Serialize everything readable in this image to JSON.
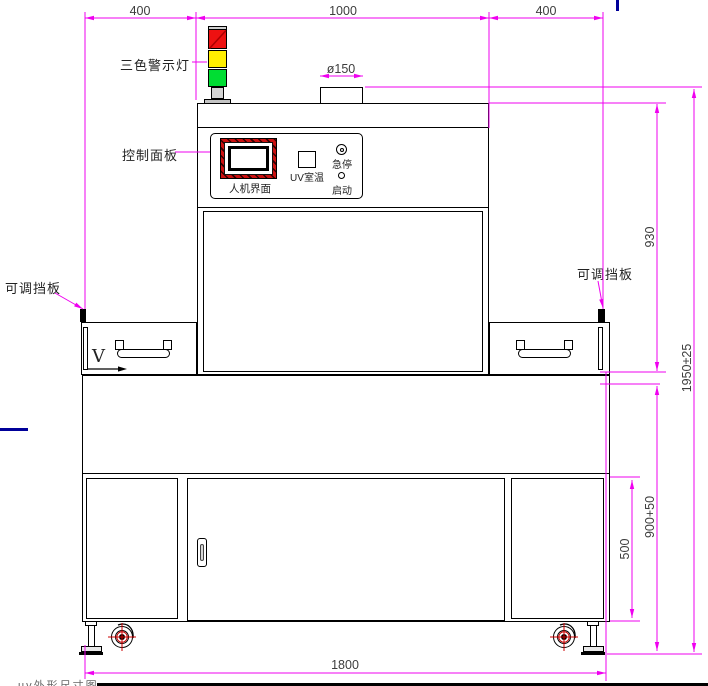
{
  "labels": {
    "tower_light": "三色警示灯",
    "control_panel": "控制面板",
    "hmi": "人机界面",
    "uv_temp": "UV室温",
    "estop": "急停",
    "start": "启动",
    "baffle_left": "可调挡板",
    "baffle_right": "可调挡板",
    "direction": "V"
  },
  "dims": {
    "top_left": "400",
    "top_center": "1000",
    "top_right": "400",
    "duct_diameter": "ø150",
    "upper_height": "930",
    "total_height": "1950±25",
    "base_height": "900+50",
    "door_height": "500",
    "overall_width": "1800"
  },
  "footer_fragment": "uv外形尺寸图",
  "colors": {
    "dimension_line": "#ef00ef",
    "outline": "#000000",
    "warning_red": "#ee1111",
    "warning_yellow": "#ffee00",
    "warning_green": "#00dd33",
    "hmi_frame_red": "#cc1111",
    "caster_mark_red": "#cc0000",
    "stray_blue": "#000099"
  }
}
